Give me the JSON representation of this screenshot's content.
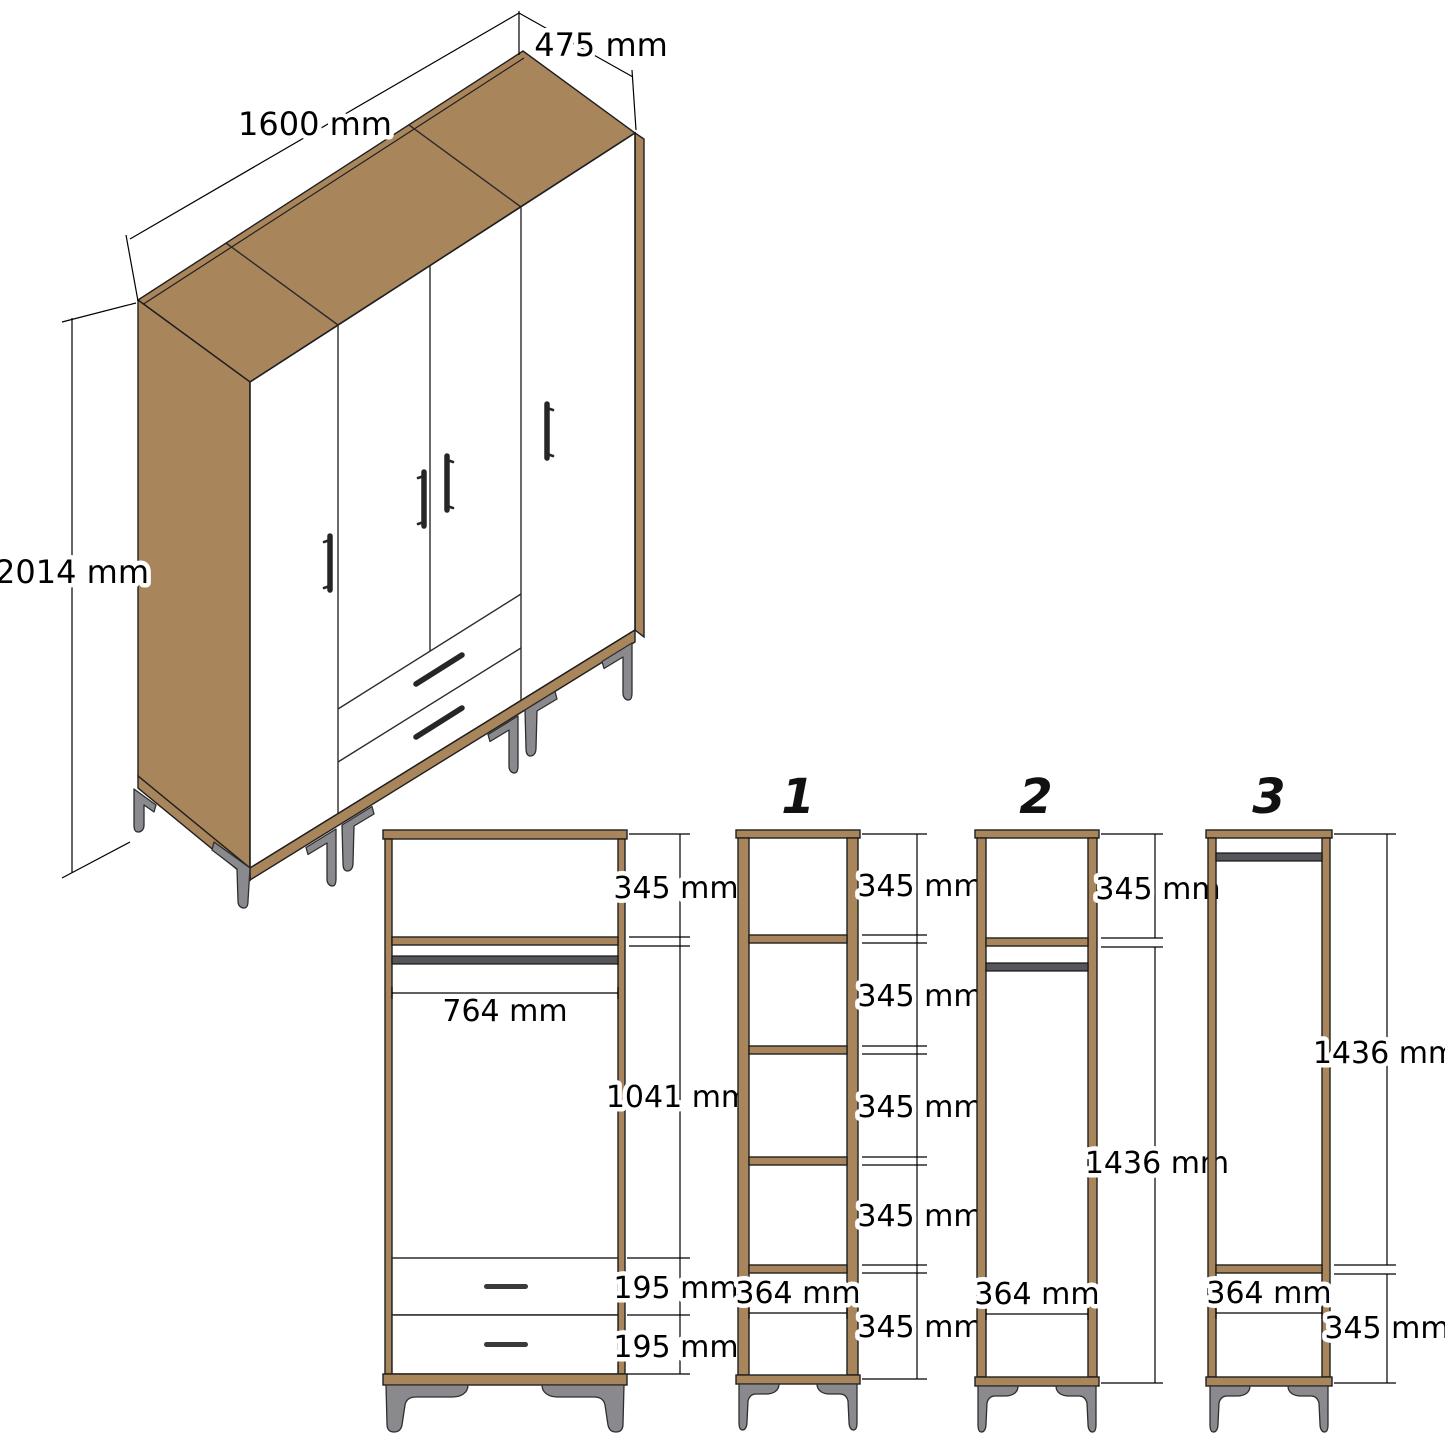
{
  "colors": {
    "wood": "#A9855C",
    "outline": "#1F1F1F",
    "hanging_rod": "#55565A",
    "metal_leg": "#8A8A8E",
    "dimension_line": "#000000",
    "background": "#FFFFFF"
  },
  "isometric_view": {
    "width_label": "1600 mm",
    "depth_label": "475 mm",
    "height_label": "2014 mm"
  },
  "front_view": {
    "top_compartment_label": "345 mm",
    "inner_width_label": "764 mm",
    "hanging_space_label": "1041 mm",
    "drawer_1_label": "195 mm",
    "drawer_2_label": "195 mm"
  },
  "sections": [
    {
      "number": "1",
      "compartment_labels": [
        "345 mm",
        "345 mm",
        "345 mm",
        "345 mm",
        "345 mm"
      ],
      "inner_width_label": "364 mm"
    },
    {
      "number": "2",
      "top_compartment_label": "345 mm",
      "hanging_space_label": "1436 mm",
      "inner_width_label": "364 mm"
    },
    {
      "number": "3",
      "hanging_space_label": "1436 mm",
      "bottom_compartment_label": "345 mm",
      "inner_width_label": "364 mm"
    }
  ]
}
